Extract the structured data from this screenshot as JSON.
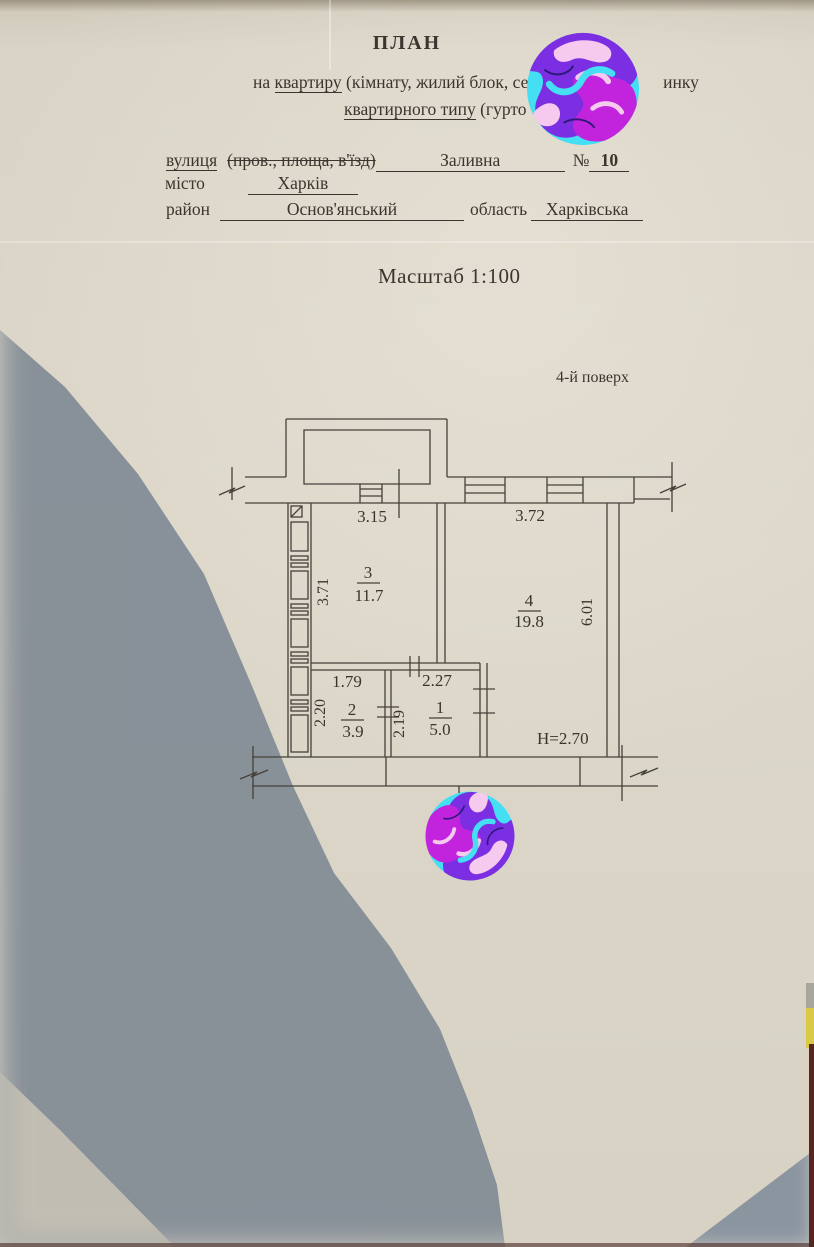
{
  "header": {
    "title": "ПЛАН",
    "line1_prefix": "на ",
    "line1_underlined": "квартиру",
    "line1_middle": " (кімнату, жилий блок, секці",
    "line1_suffix": "инку",
    "line2_underlined": "квартирного типу",
    "line2_suffix": " (гурто"
  },
  "address": {
    "street_label": "вулиця",
    "street_struck": "(пров., площа, в'їзд)",
    "street_value": "Заливна",
    "number_label": "№",
    "number_value": "10",
    "city_label": "місто",
    "city_value": "Харків",
    "district_label": "район",
    "district_value": "Основ'янський",
    "region_label": "область",
    "region_value": "Харківська"
  },
  "scale_text": "Масштаб 1:100",
  "floor_text": "4-й поверх",
  "plan": {
    "dim_top_left": "3.15",
    "dim_top_right": "3.72",
    "dim_left": "3.71",
    "dim_right": "6.01",
    "dim_room2_width": "1.79",
    "dim_room1_width": "2.27",
    "dim_room2_depth": "2.20",
    "dim_room1_depth": "2.19",
    "ceiling_height": "Н=2.70",
    "room3": {
      "number": "3",
      "area": "11.7"
    },
    "room4": {
      "number": "4",
      "area": "19.8"
    },
    "room2": {
      "number": "2",
      "area": "3.9"
    },
    "room1": {
      "number": "1",
      "area": "5.0"
    }
  },
  "colors": {
    "paper": "#dcd7c9",
    "shadow": "#7d8792",
    "ink": "#3a362f",
    "sticker_cyan": "#44dff2",
    "sticker_purple": "#7c2ee2",
    "sticker_magenta": "#c224dd",
    "sticker_pink": "#f6c9ee"
  }
}
